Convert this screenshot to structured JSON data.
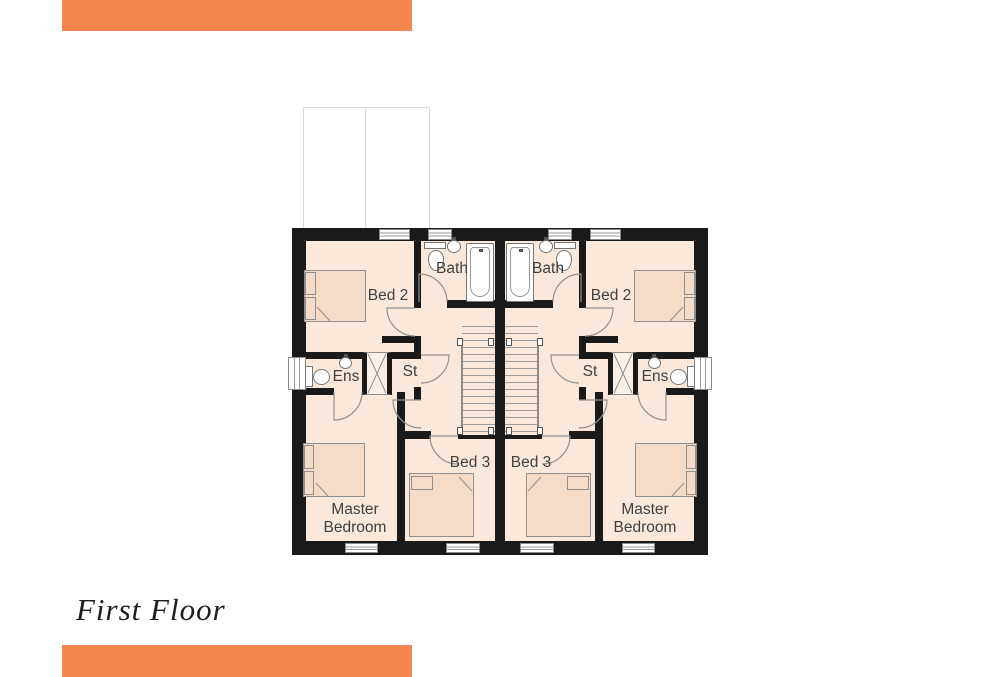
{
  "title": "First Floor",
  "colors": {
    "accent": "#F5854F",
    "wall": "#1A1A1A",
    "floor": "#FAE8DB",
    "furniture": "#F6DBC6"
  },
  "plan": {
    "type": "floor-plan",
    "left_house": {
      "bed2": "Bed 2",
      "bath": "Bath",
      "ens": "Ens",
      "st": "St",
      "bed3": "Bed 3",
      "master_line1": "Master",
      "master_line2": "Bedroom"
    },
    "right_house": {
      "bed2": "Bed 2",
      "bath": "Bath",
      "ens": "Ens",
      "st": "St",
      "bed3": "Bed 3",
      "master_line1": "Master",
      "master_line2": "Bedroom"
    }
  }
}
